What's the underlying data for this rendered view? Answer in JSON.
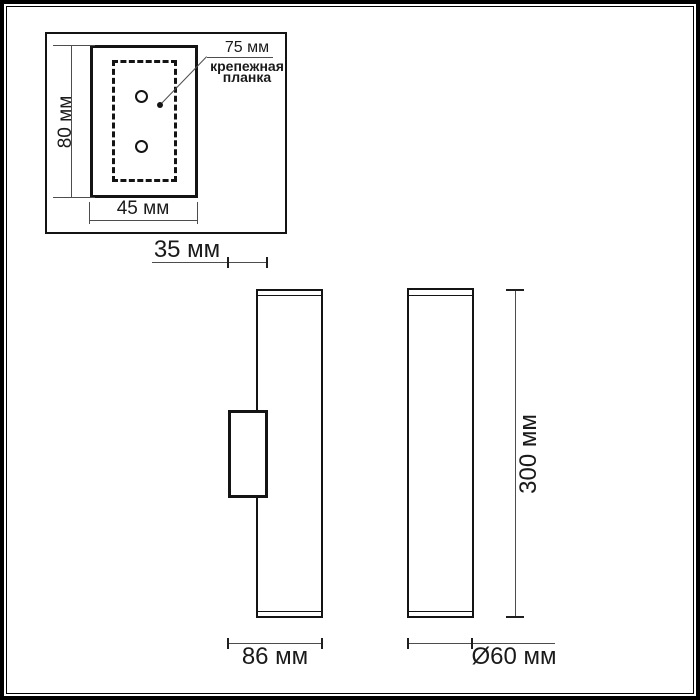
{
  "page": {
    "background": "#ffffff",
    "object_line_color": "#141414",
    "dimension_line_color": "#4d4d4d"
  },
  "detail_inset": {
    "height_label": "80 мм",
    "width_label": "45 мм",
    "pitch_label": "75 мм",
    "callout_line1": "крепежная",
    "callout_line2": "планка"
  },
  "dimensions": {
    "wall_offset": "35 мм",
    "body_height": "300 мм",
    "side_depth": "86 мм",
    "diameter": "Ø60 мм"
  }
}
